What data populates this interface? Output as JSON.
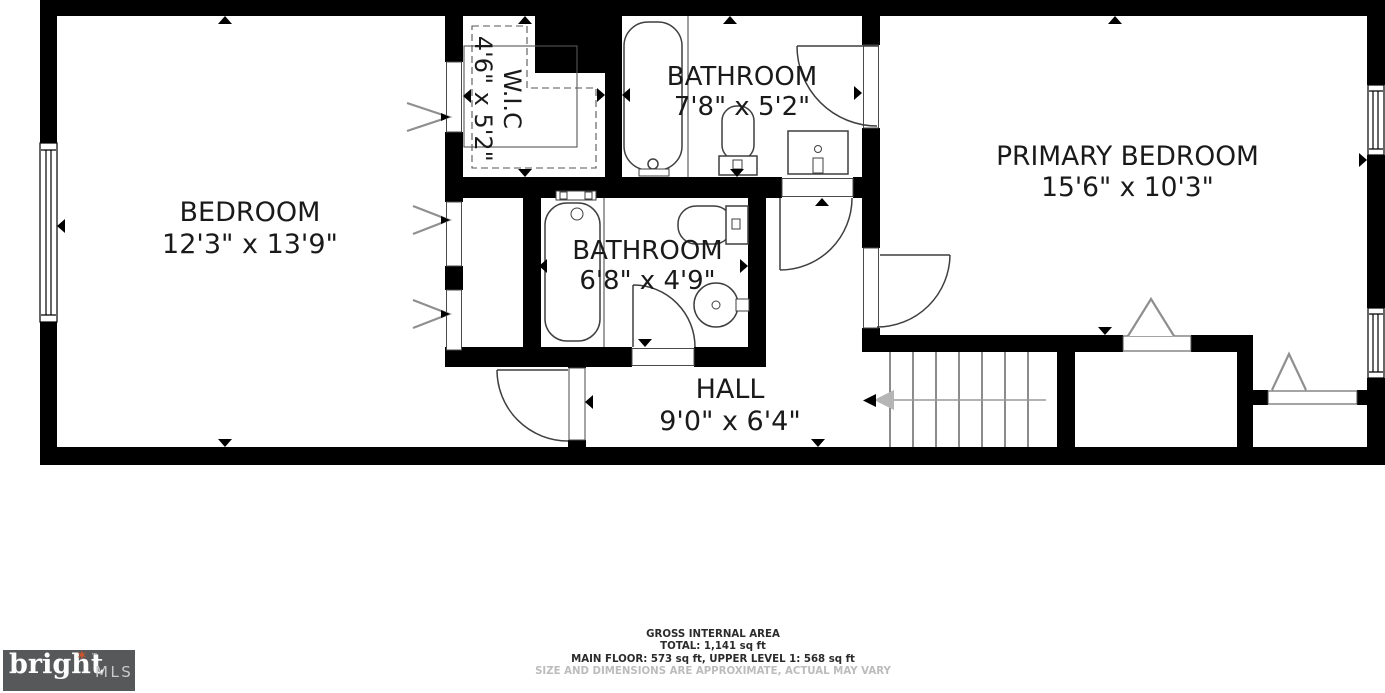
{
  "rooms": {
    "bedroom": {
      "name": "BEDROOM",
      "dims": "12'3\" x 13'9\""
    },
    "wic": {
      "name": "W.I.C",
      "dims": "4'6\" x 5'2\""
    },
    "bathroom_top": {
      "name": "BATHROOM",
      "dims": "7'8\" x 5'2\""
    },
    "bathroom_mid": {
      "name": "BATHROOM",
      "dims": "6'8\" x 4'9\""
    },
    "primary": {
      "name": "PRIMARY BEDROOM",
      "dims": "15'6\" x 10'3\""
    },
    "hall": {
      "name": "HALL",
      "dims": "9'0\" x 6'4\""
    }
  },
  "footer": {
    "area_title": "GROSS INTERNAL AREA",
    "total": "TOTAL: 1,141 sq ft",
    "breakdown": "MAIN FLOOR: 573 sq ft, UPPER LEVEL 1: 568 sq ft",
    "disclaimer": "SIZE AND DIMENSIONS ARE APPROXIMATE, ACTUAL MAY VARY"
  },
  "logo": {
    "brand": "bright",
    "tm": "™",
    "suffix": "MLS"
  },
  "colors": {
    "wall": "#000000",
    "fixture_stroke": "#3f3f3f",
    "door_symbol": "#8f8f8f",
    "label": "#1a1a1a",
    "disclaimer": "#bcbcbc",
    "logo_bg": "#57585a",
    "logo_star": "#d4552a"
  }
}
